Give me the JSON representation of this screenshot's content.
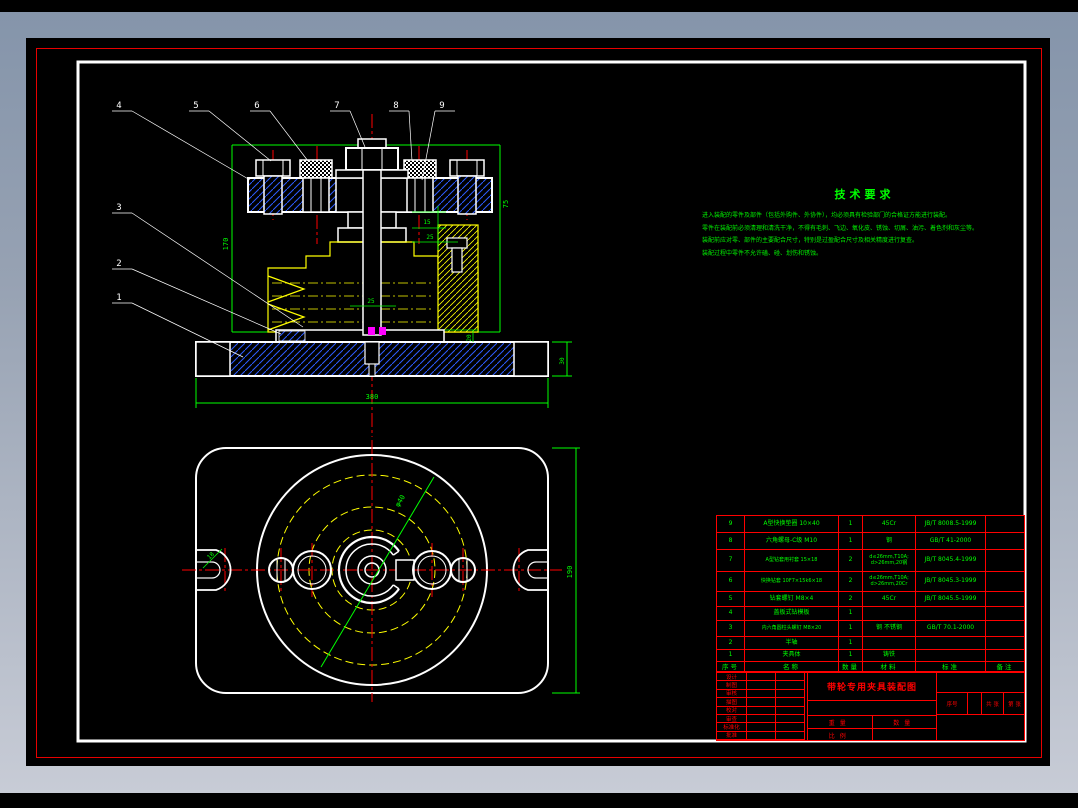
{
  "window": {
    "bg_top": "#8494aa",
    "bg_bottom": "#c9cdd7",
    "canvas_bg": "#000000",
    "frame_red": "#e80000",
    "sheet_border": "#ffffff"
  },
  "colors": {
    "geometry_white": "#ffffff",
    "hatch_blue": "#2d5cff",
    "workpiece_yellow": "#ffff00",
    "dimension_green": "#00ff00",
    "centerline_red": "#ff0000",
    "pin_magenta": "#ff00ff"
  },
  "tech_req": {
    "title": "技术要求",
    "lines": [
      "进入装配的零件及部件（包括外购件、外协件），均必须具有检验部门的合格证方能进行装配。",
      "零件在装配前必须清理和清洗干净，不得有毛刺、飞边、氧化皮、锈蚀、切屑、油污、着色剂和灰尘等。",
      "装配前应对零、部件的主要配合尺寸，特别是过盈配合尺寸及相关精度进行复查。",
      "装配过程中零件不允许磕、碰、划伤和锈蚀。"
    ]
  },
  "callouts": {
    "c1": "1",
    "c2": "2",
    "c3": "3",
    "c4": "4",
    "c5": "5",
    "c6": "6",
    "c7": "7",
    "c8": "8",
    "c9": "9"
  },
  "dims": {
    "overall_height": "170",
    "right_height": "75",
    "bush_depth": "15",
    "bush_step": "25",
    "boss_dia": "25",
    "base_width": "380",
    "base_height": "30",
    "plate_step": "20",
    "plan_bolt_circle": "φ40",
    "plan_height": "190",
    "slot_width": "18"
  },
  "parts_table": {
    "headers": [
      "序号",
      "名称",
      "数量",
      "材料",
      "标准",
      "备注"
    ],
    "rows": [
      [
        "9",
        "A型快换垫圈 10×40",
        "1",
        "45Cr",
        "JB/T 8008.5-1999",
        ""
      ],
      [
        "8",
        "六角螺母-C级 M10",
        "1",
        "钢",
        "GB/T 41-2000",
        ""
      ],
      [
        "7",
        "A型钻套用衬套 15×18",
        "2",
        "d≤26mm,T10A; d>26mm,20钢",
        "JB/T 8045.4-1999",
        ""
      ],
      [
        "6",
        "快换钻套 10F7×15k6×18",
        "2",
        "d≤26mm,T10A; d>26mm,20Cr",
        "JB/T 8045.3-1999",
        ""
      ],
      [
        "5",
        "钻套螺钉 M8×4",
        "2",
        "45Cr",
        "JB/T 8045.5-1999",
        ""
      ],
      [
        "4",
        "盖板式钻模板",
        "1",
        "",
        "",
        ""
      ],
      [
        "3",
        "内六角圆柱头螺钉 M8×20",
        "1",
        "钢 不锈钢",
        "GB/T 70.1-2000",
        ""
      ],
      [
        "2",
        "半轴",
        "1",
        "",
        "",
        ""
      ],
      [
        "1",
        "夹具体",
        "1",
        "铸铁",
        "",
        ""
      ]
    ]
  },
  "title_block": {
    "drawing_title": "带轮专用夹具装配图",
    "left_labels": [
      "设计",
      "制图",
      "审核",
      "描图",
      "校对",
      "审查",
      "标准化",
      "批准"
    ],
    "weight_label": "重量",
    "qty_label": "数量",
    "scale_label": "比例",
    "serial_label": "序号",
    "sheets_label": "共  张",
    "sheet_no_label": "第  张"
  }
}
